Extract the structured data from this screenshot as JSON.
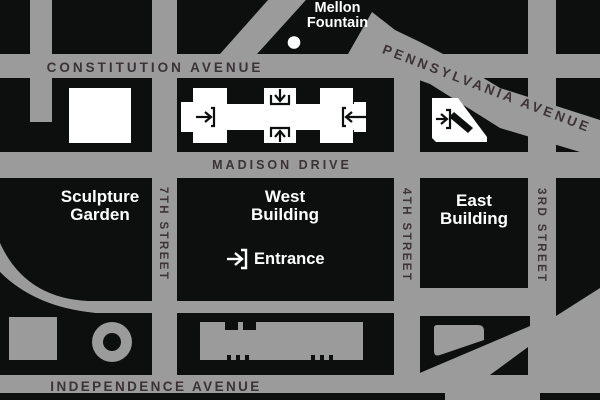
{
  "map": {
    "colors": {
      "background_black": "#0D0E0E",
      "road_gray": "#9B9B9B",
      "street_label_dark": "#3B3337",
      "building_white": "#FFFFFF"
    },
    "streets": {
      "constitution": "CONSTITUTION AVENUE",
      "pennsylvania": "PENNSYLVANIA AVENUE",
      "madison": "MADISON DRIVE",
      "independence": "INDEPENDENCE AVENUE",
      "seventh": "7TH STREET",
      "fourth": "4TH STREET",
      "third": "3RD STREET"
    },
    "places": {
      "mellon_fountain": {
        "line1": "Mellon",
        "line2": "Fountain"
      },
      "sculpture_garden": {
        "line1": "Sculpture",
        "line2": "Garden"
      },
      "west_building": {
        "line1": "West",
        "line2": "Building"
      },
      "east_building": {
        "line1": "East",
        "line2": "Building"
      },
      "entrance": {
        "label": "Entrance"
      }
    },
    "icons": {
      "west_building_entrances": [
        "arrow-right-door-icon",
        "arrow-down-door-icon",
        "arrow-up-door-icon",
        "arrow-left-door-icon"
      ],
      "east_building_entrance": "arrow-right-door-icon",
      "mall_entrance": "arrow-right-door-icon",
      "fountain_marker": "dot-icon"
    }
  }
}
